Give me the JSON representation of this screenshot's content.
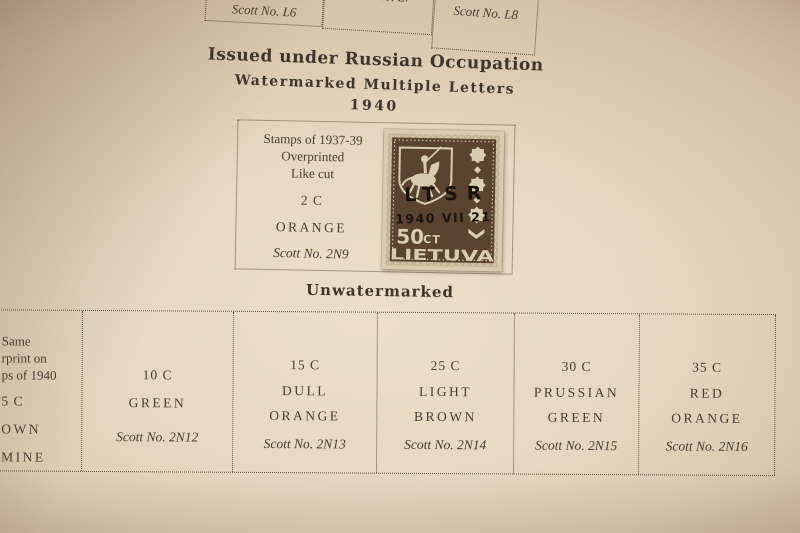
{
  "page": {
    "top_boxes": [
      {
        "scott": "Scott No. L6"
      },
      {
        "label": "AND GREEN",
        "scott": "Scott No. L7"
      },
      {
        "label": "AND ORANGE",
        "scott": "Scott No. L8"
      }
    ],
    "heading": {
      "title": "Issued under Russian Occupation",
      "subtitle": "Watermarked Multiple Letters",
      "year": "1940"
    },
    "featured_box": {
      "desc_lines": [
        "Stamps of 1937-39",
        "Overprinted",
        "Like cut"
      ],
      "denomination": "2 C",
      "color_name": "ORANGE",
      "scott": "Scott No. 2N9"
    },
    "stamp": {
      "country": "LIETUVA",
      "value": "50",
      "value_unit": "CT",
      "overprint_line1": "LTSR",
      "overprint_line2": "1940 VII 21",
      "ink_color": "#5b442f",
      "paper_color": "#d8cbae",
      "overprint_color": "#17130e"
    },
    "section2_heading": "Unwatermarked",
    "bottom_boxes": [
      {
        "note_lines": [
          "Same",
          "rprint on",
          "ps of 1940"
        ],
        "denomination": "5 C",
        "color_lines": [
          "OWN",
          "MINE"
        ]
      },
      {
        "denomination": "10 C",
        "color_lines": [
          "GREEN"
        ],
        "scott": "Scott No. 2N12"
      },
      {
        "denomination": "15 C",
        "color_lines": [
          "DULL",
          "ORANGE"
        ],
        "scott": "Scott No. 2N13"
      },
      {
        "denomination": "25 C",
        "color_lines": [
          "LIGHT",
          "BROWN"
        ],
        "scott": "Scott No. 2N14"
      },
      {
        "denomination": "30 C",
        "color_lines": [
          "PRUSSIAN",
          "GREEN"
        ],
        "scott": "Scott No. 2N15"
      },
      {
        "denomination": "35 C",
        "color_lines": [
          "RED",
          "ORANGE"
        ],
        "scott": "Scott No. 2N16"
      }
    ]
  }
}
